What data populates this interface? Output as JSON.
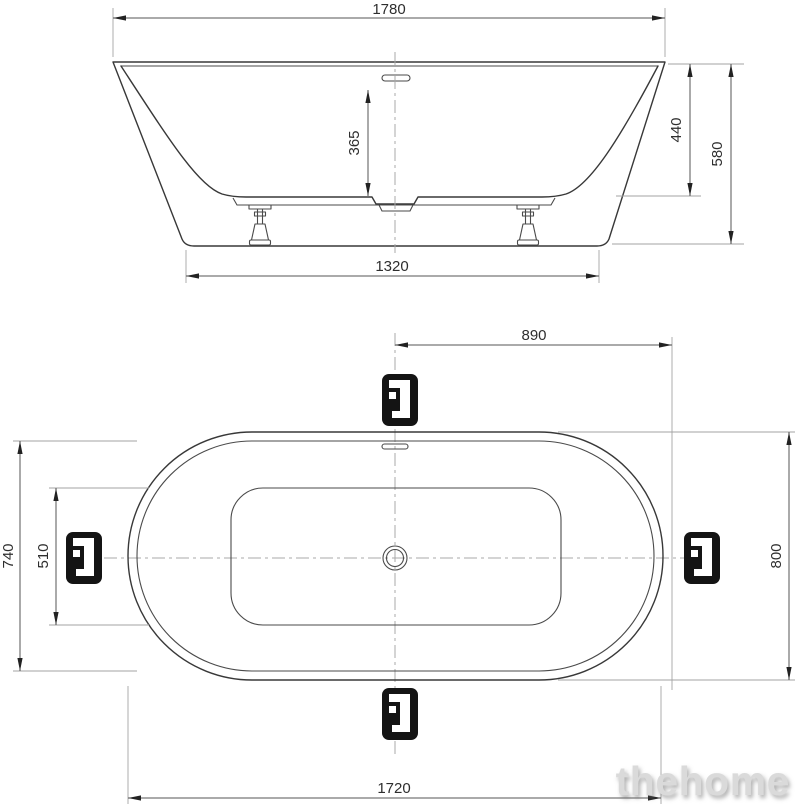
{
  "side_view": {
    "dims": {
      "overall_length": "1780",
      "depth_to_overflow": "365",
      "rim_to_basin_bottom": "440",
      "overall_height": "580",
      "base_length": "1320"
    }
  },
  "top_view": {
    "dims": {
      "center_to_end": "890",
      "rim_inner_width": "740",
      "basin_width": "510",
      "overall_width": "800",
      "overall_length": "1720"
    }
  },
  "icons": {
    "faucet_position": "faucet-position-icon"
  },
  "watermark": {
    "text": "thehome"
  },
  "colors": {
    "background": "#ffffff",
    "object_line": "#383838",
    "dimension_line": "#555555",
    "extension_line": "#a3a3a3",
    "centerline": "#a8a8a8",
    "dimension_text": "#2e2e2e",
    "icon_background": "#141414",
    "icon_glyph": "#ffffff",
    "watermark": "#dadada"
  }
}
